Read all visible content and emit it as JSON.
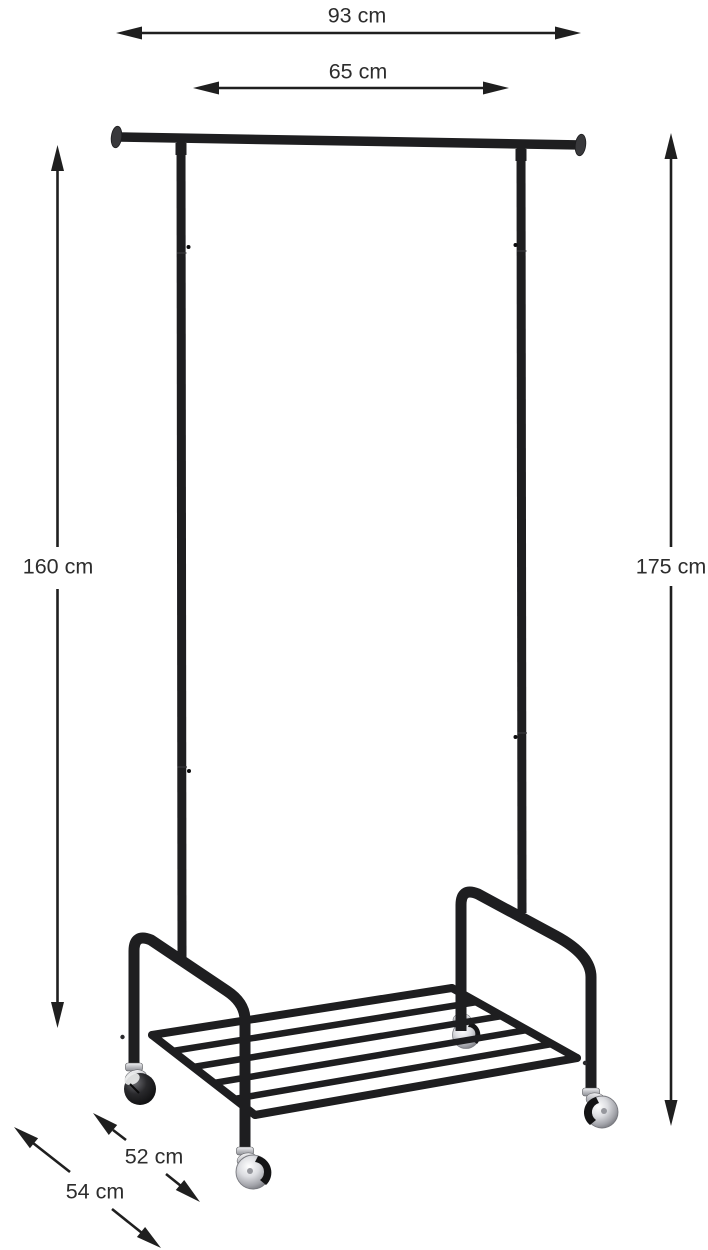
{
  "diagram": {
    "type": "product-dimension-diagram",
    "product_description": "black metal garment rack with hanging rail, bottom shelf and four swivel casters",
    "unit": "cm"
  },
  "dimensions": [
    {
      "id": "total-width",
      "label": "93 cm",
      "value": 93,
      "orientation": "horizontal"
    },
    {
      "id": "rail-width",
      "label": "65 cm",
      "value": 65,
      "orientation": "horizontal"
    },
    {
      "id": "left-height",
      "label": "160 cm",
      "value": 160,
      "orientation": "vertical"
    },
    {
      "id": "right-height",
      "label": "175 cm",
      "value": 175,
      "orientation": "vertical"
    },
    {
      "id": "depth-upper",
      "label": "52 cm",
      "value": 52,
      "orientation": "diagonal"
    },
    {
      "id": "depth-lower",
      "label": "54 cm",
      "value": 54,
      "orientation": "diagonal"
    }
  ],
  "colors": {
    "background": "#ffffff",
    "rack": "#1e1e20",
    "rack_dark": "#131314",
    "chrome": "#c9cacf",
    "dimension_line": "#1f1f1f",
    "label_text": "#2d2d2d"
  }
}
